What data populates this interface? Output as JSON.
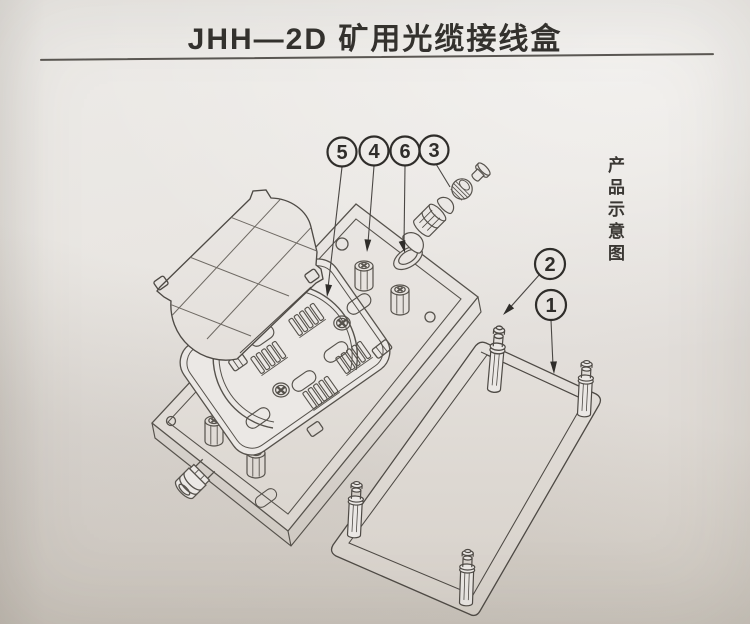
{
  "header": {
    "title": "JHH—2D 矿用光缆接线盒"
  },
  "caption": {
    "vertical_text": "产品示意图"
  },
  "callouts": {
    "c1": "1",
    "c2": "2",
    "c3": "3",
    "c4": "4",
    "c5": "5",
    "c6": "6"
  },
  "colors": {
    "paper": "#e7e4e0",
    "line": "#56524c",
    "ink": "#2f2d2a",
    "rule": "#45423e"
  }
}
